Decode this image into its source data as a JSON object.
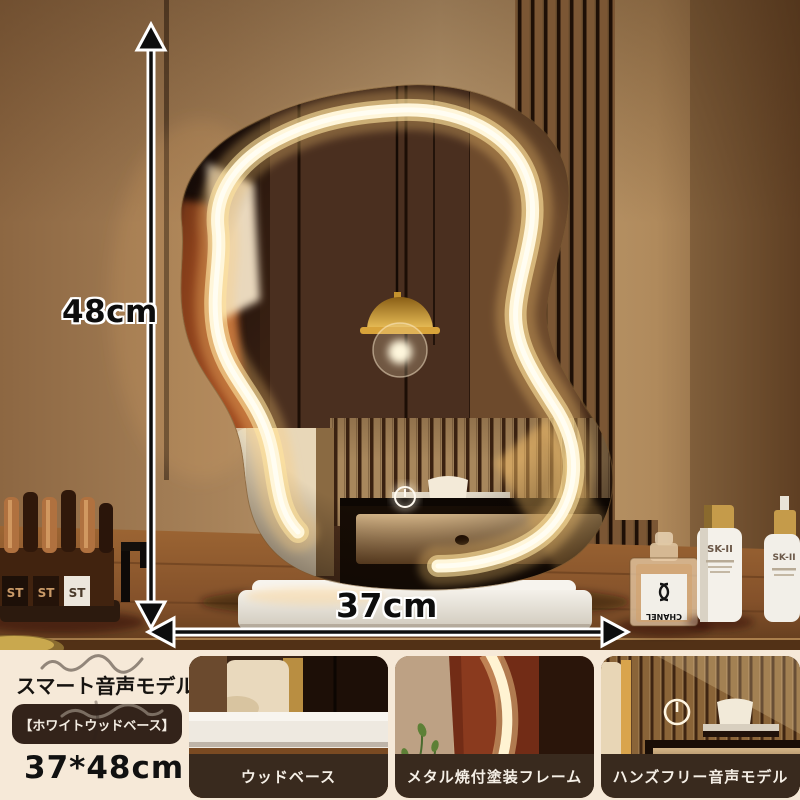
{
  "annotations": {
    "height_label": "48cm",
    "width_label": "37cm"
  },
  "info_panel": {
    "model_title": "スマート音声モデル",
    "variant_badge": "【ホワイトウッドベース】",
    "size_text": "37*48cm"
  },
  "thumbnails": [
    {
      "caption": "ウッドベース"
    },
    {
      "caption": "メタル焼付塗装フレーム"
    },
    {
      "caption": "ハンズフリー音声モデル"
    }
  ],
  "scene": {
    "perfume_brand": "CHANEL",
    "skincare_brand_1": "SK-II",
    "skincare_brand_2": "SK-II",
    "lipstick_label_1": "ST",
    "lipstick_label_2": "ST",
    "lipstick_label_3": "ST"
  },
  "colors": {
    "led_glow": "#fff3d6",
    "caption_bar": "#392a1e",
    "badge_bg": "#33231a",
    "background": "#f6e9d8",
    "arrow": "#0d0d0d",
    "base_white": "#f1ede5"
  }
}
